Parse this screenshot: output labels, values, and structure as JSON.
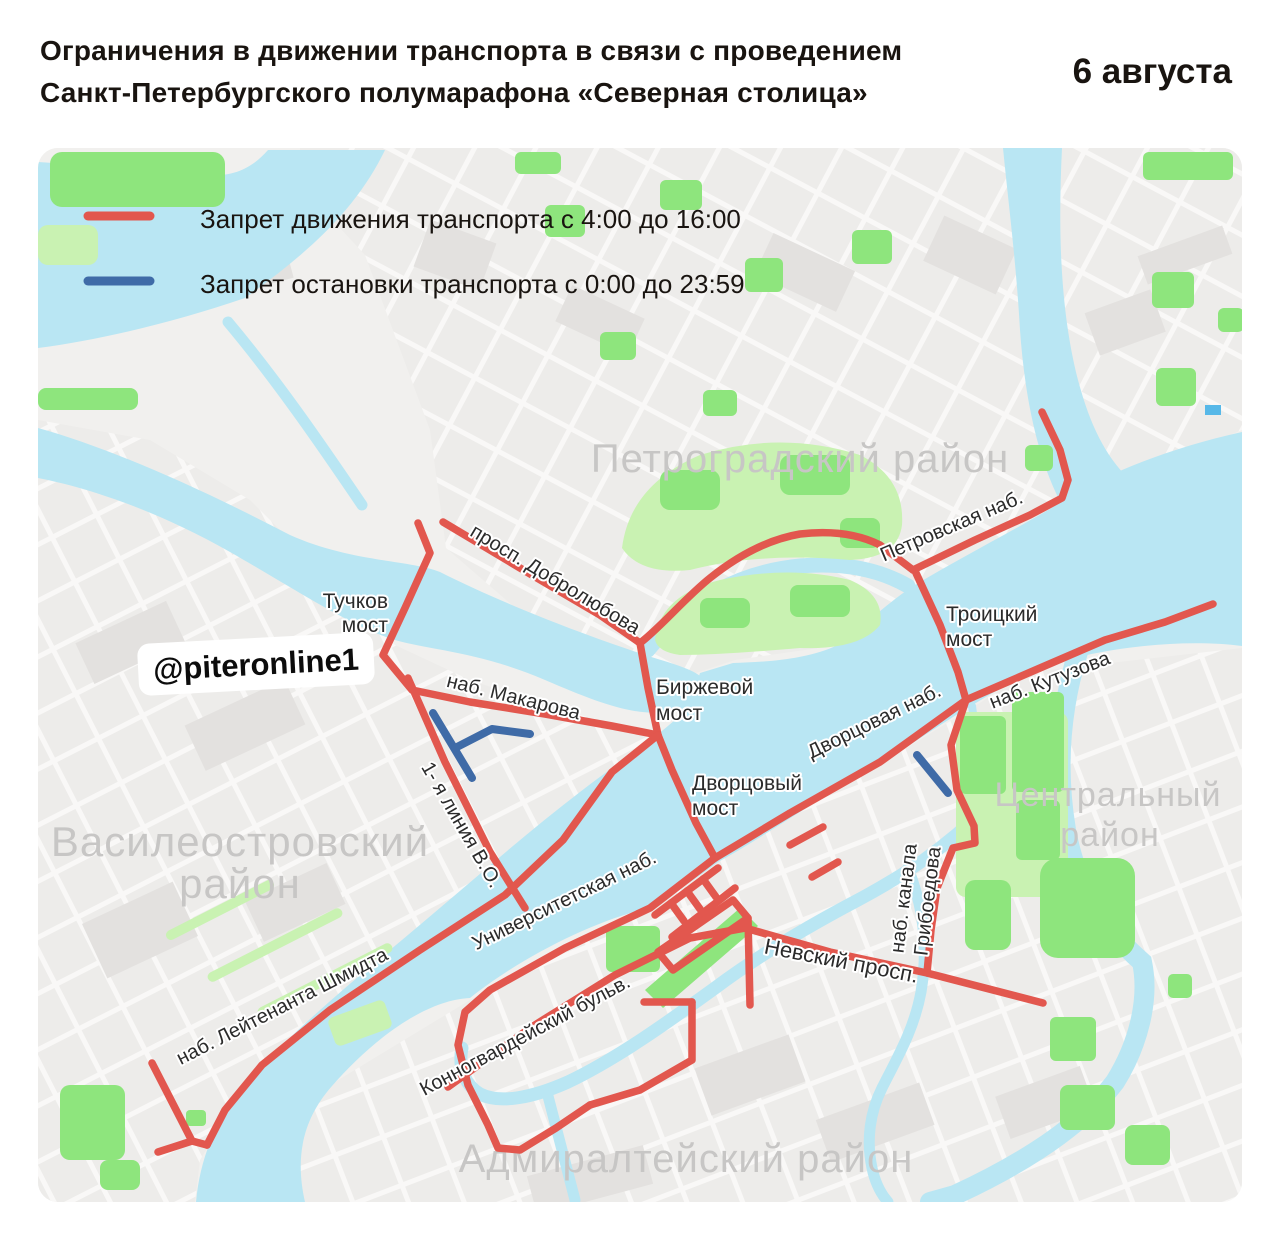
{
  "header": {
    "title_line1": "Ограничения в движении транспорта в связи с проведением",
    "title_line2": "Санкт-Петербургского полумарафона «Северная столица»",
    "date": "6 августа"
  },
  "legend": {
    "no_driving": "Запрет движения транспорта с 4:00 до 16:00",
    "no_stopping": "Запрет остановки транспорта с 0:00 до 23:59"
  },
  "watermark": {
    "handle": "@piteronline1"
  },
  "districts": {
    "petrogradsky": "Петроградский район",
    "vasileostrovsky_line1": "Василеостровский",
    "vasileostrovsky_line2": "район",
    "central_line1": "Центральный",
    "central_line2": "район",
    "admiralteysky": "Адмиралтейский район"
  },
  "streets": {
    "tuchkov_line1": "Тучков",
    "tuchkov_line2": "мост",
    "dobrolyubova": "просп. Добролюбова",
    "makarova": "наб. Макарова",
    "birzhevoy_line1": "Биржевой",
    "birzhevoy_line2": "мост",
    "petrovskaya": "Петровская наб.",
    "troitsky_line1": "Троицкий",
    "troitsky_line2": "мост",
    "dvortsovaya": "Дворцовая наб.",
    "kutuzova": "наб. Кутузова",
    "dvortsovy_line1": "Дворцовый",
    "dvortsovy_line2": "мост",
    "liniya_vo": "1- я линия В.О.",
    "universitetskaya": "Университетская наб.",
    "leytenanta_shmidta": "наб. Лейтенанта Шмидта",
    "konnogvardeysky": "Конногвардейский бульв.",
    "nevsky": "Невский просп.",
    "griboedova_line1": "наб. канала",
    "griboedova_line2": "Грибоедова"
  },
  "colors": {
    "road_closed": "#e2574e",
    "no_stopping": "#3f6ba7",
    "water": "#b9e6f3",
    "green_bright": "#8ee57d",
    "green_light": "#c9f2b2",
    "district_label": "#c7c6c5"
  }
}
